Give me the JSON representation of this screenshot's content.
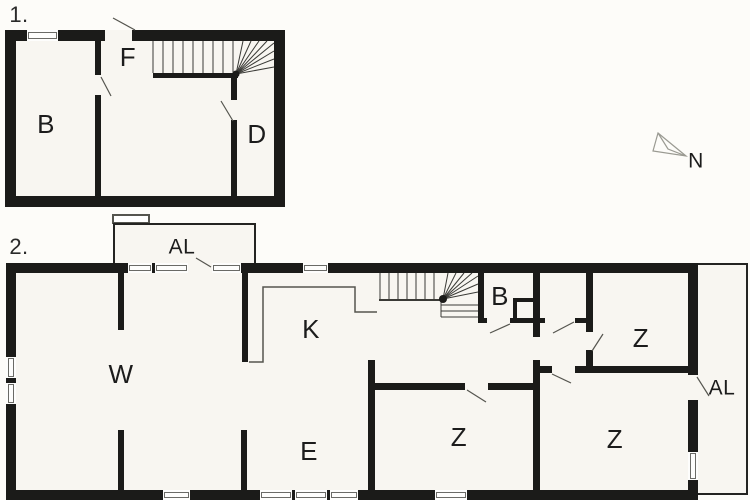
{
  "document": {
    "type": "floor-plan",
    "floors_shown": 2
  },
  "colors": {
    "wall": "#1b1b19",
    "floor_fill": "#f8f6f1",
    "page_background": "#fdfcf9",
    "thin_line": "#55554f",
    "compass_line": "#9a9a92",
    "text": "#1c1c1c"
  },
  "floor1": {
    "label": "1.",
    "rooms": [
      {
        "id": "b",
        "label": "B"
      },
      {
        "id": "f",
        "label": "F"
      },
      {
        "id": "d",
        "label": "D"
      }
    ]
  },
  "floor2": {
    "label": "2.",
    "rooms": [
      {
        "id": "w",
        "label": "W"
      },
      {
        "id": "k",
        "label": "K"
      },
      {
        "id": "b",
        "label": "B"
      },
      {
        "id": "e",
        "label": "E"
      },
      {
        "id": "z-top-right",
        "label": "Z"
      },
      {
        "id": "z-bottom-middle",
        "label": "Z"
      },
      {
        "id": "z-bottom-right",
        "label": "Z"
      },
      {
        "id": "al-top-annex",
        "label": "AL"
      },
      {
        "id": "al-right-annex",
        "label": "AL"
      }
    ]
  },
  "compass": {
    "label": "N"
  }
}
